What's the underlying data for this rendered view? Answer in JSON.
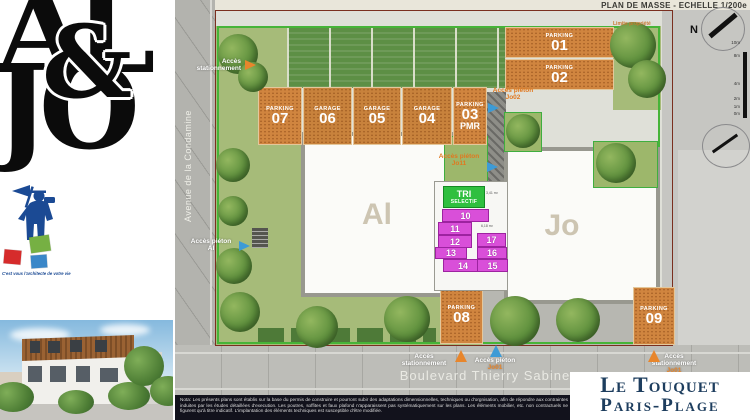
{
  "title": "PLAN DE MASSE - ECHELLE 1/200e",
  "limite_label": "Limite propriété",
  "brand": {
    "top": "AL",
    "amp": "&",
    "bottom": "JO",
    "tagline": "C'est vous l'architecte de votre vie"
  },
  "streets": {
    "avenue": "Avenue de la Condamine",
    "boulevard": "Boulevard Thierry Sabine"
  },
  "city_logo": {
    "line1": "Le Touquet",
    "line2": "Paris-Plage"
  },
  "buildings": {
    "al": "Al",
    "jo": "Jo"
  },
  "spots": {
    "p01": {
      "kind": "PARKING",
      "num": "01"
    },
    "p02": {
      "kind": "PARKING",
      "num": "02"
    },
    "p07": {
      "kind": "PARKING",
      "num": "07"
    },
    "g06": {
      "kind": "GARAGE",
      "num": "06"
    },
    "g05": {
      "kind": "GARAGE",
      "num": "05"
    },
    "g04": {
      "kind": "GARAGE",
      "num": "04"
    },
    "p03": {
      "kind": "PARKING",
      "num": "03",
      "sub": "PMR"
    },
    "p08": {
      "kind": "PARKING",
      "num": "08"
    },
    "p09": {
      "kind": "PARKING",
      "num": "09"
    }
  },
  "tri": {
    "line1": "TRI",
    "line2": "SELECTIF"
  },
  "cells": [
    "10",
    "11",
    "12",
    "17",
    "13",
    "16",
    "14",
    "15"
  ],
  "areas": {
    "a1": "3,41 m²",
    "a2": "6,18 m²"
  },
  "access": {
    "top_left": {
      "l1": "Accès",
      "l2": "stationnement"
    },
    "al": {
      "l1": "Accès piéton",
      "l2": "Al"
    },
    "jo02": {
      "l1": "Accès piéton",
      "l2": "Jo02"
    },
    "jo11": {
      "l1": "Accès piéton",
      "l2": "Jo11"
    },
    "bottom_park": {
      "l1": "Accès",
      "l2": "stationnement"
    },
    "bottom_ped": {
      "l1": "Accès piéton",
      "l2": "Jo01"
    },
    "right_park": {
      "l1": "Accès",
      "l2": "stationnement",
      "l3": "Jo01"
    }
  },
  "compass_n": "N",
  "scale_labels": [
    "10m",
    "8m",
    "4m",
    "2m",
    "1m",
    "0m"
  ],
  "note": "Nota: Les présents plans sont établis sur la base du permis de construire et pourront subir des adaptations dimensionnelles, techniques ou d'orgnisation, afin de répondre aux contraintes induites par les études détaillées d'execution. Les poutres, soffites et faux plafond n'apparaissent pas systématiquement sur les plans. Les éléments mobilier, etc. non contractuels ne figurent qu'à titre indicatif. L'implantation des éléments techniques est susceptible d'être modifiée.",
  "colors": {
    "parking_orange": "#d0853f",
    "cell_magenta": "#d94fd9",
    "tri_green": "#2fbf3f",
    "site_border_green": "#46b438",
    "property_red": "#7a2f1f",
    "city_navy": "#1d3d5e",
    "brand_blue": "#1b4a94"
  }
}
